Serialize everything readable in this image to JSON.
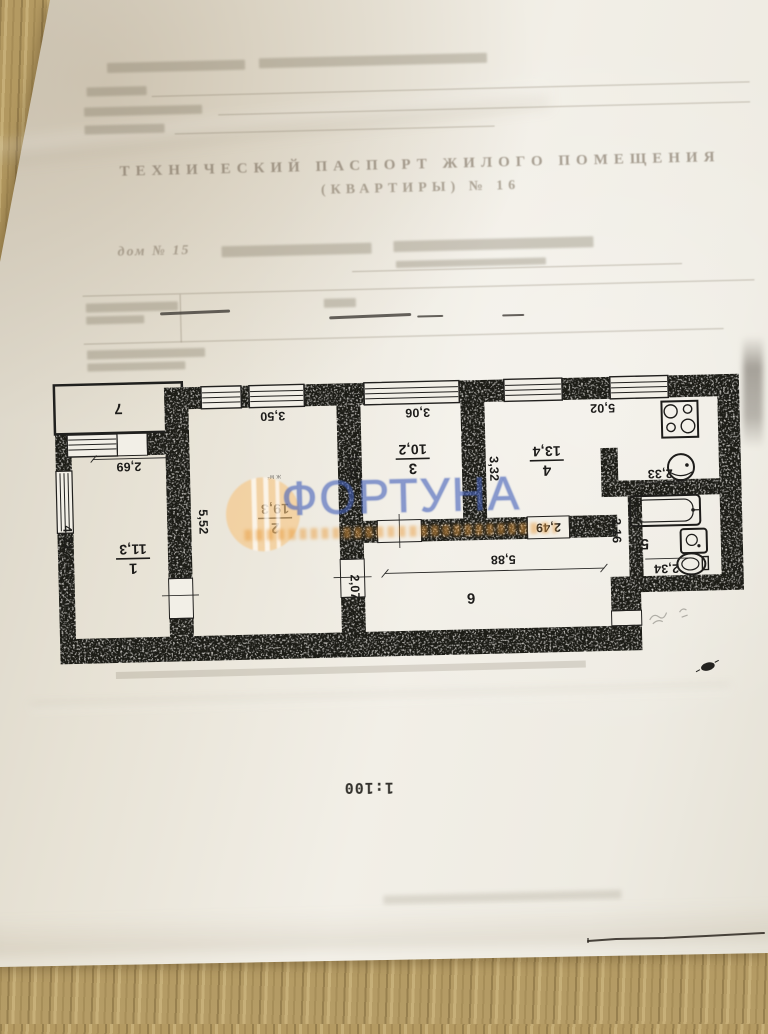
{
  "document": {
    "title_line1": "ТЕХНИЧЕСКИЙ ПАСПОРТ ЖИЛОГО ПОМЕЩЕНИЯ",
    "title_line2": "(КВАРТИРЫ) № 16",
    "address_visible": "дом № 15",
    "scale_label": "1:100"
  },
  "watermark": {
    "brand": "ФОРТУНА",
    "brand_blue": "#4964bc",
    "brand_orange": "#f6c480"
  },
  "floor_plan": {
    "rooms": {
      "r1": {
        "number": "1",
        "area": "11,3"
      },
      "r2": {
        "number": "2",
        "area": "19,3"
      },
      "r3": {
        "number": "3",
        "area": "10,2"
      },
      "r4": {
        "number": "4",
        "area": "13,4"
      },
      "r5": {
        "number": "5"
      },
      "r6": {
        "number": "6"
      },
      "r7": {
        "number": "7"
      }
    },
    "room2_note": "ж м²",
    "dims": {
      "balcony_window": "2,69",
      "room1_depth": "4,21",
      "room2_depth": "5,52",
      "room2_width": "3,50",
      "room3_width": "3,06",
      "room3_depth": "3,34",
      "room4_depth": "3,32",
      "kitchen_width": "5,02",
      "kitchen_sink": "2,33",
      "room4_door": "2,49",
      "hall_length": "5,88",
      "hall_width": "2,07",
      "bath_depth": "2,16",
      "bath_width": "2,34"
    }
  }
}
